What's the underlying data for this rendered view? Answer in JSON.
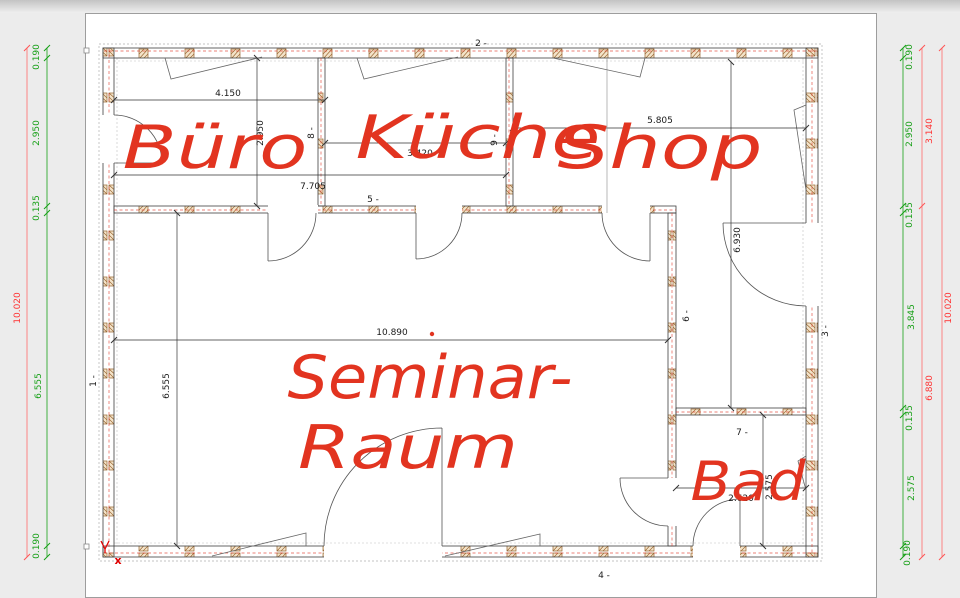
{
  "rooms": {
    "buero": "Büro",
    "kueche": "Küche",
    "shop": "Shop",
    "seminar_line1": "Seminar-",
    "seminar_line2": "Raum",
    "bad": "Bad"
  },
  "dims": {
    "buero_width": "4.150",
    "buero_height": "2.950",
    "buero_kueche_width": "7.705",
    "kueche_width": "3.420",
    "shop_width": "5.805",
    "shop_height": "6.930",
    "seminar_width": "10.890",
    "seminar_height": "6.555",
    "bad_width": "2.620",
    "bad_height": "2.575"
  },
  "wall_labels": {
    "w1": "1 -",
    "w2": "2 -",
    "w3": "3 -",
    "w4": "4 -",
    "w5": "5 -",
    "w6": "6 -",
    "w7": "7 -",
    "w8": "8 -",
    "w9": "9 -"
  },
  "left_margin": {
    "green": [
      "0.190",
      "2.950",
      "0.135",
      "6.555",
      "0.190"
    ],
    "red_total": "10.020"
  },
  "right_margin": {
    "green": [
      "0.190",
      "2.950",
      "0.135",
      "3.845",
      "0.135",
      "2.575",
      "0.190"
    ],
    "red": [
      "3.140",
      "6.880"
    ],
    "red_total": "10.020"
  },
  "origin": {
    "x_label": "x"
  },
  "colors": {
    "dim_green": "#17a017",
    "dim_red_line": "#ff6a6a",
    "dim_red_text": "#ff3333",
    "handwriting_red": "#e23420",
    "wall_hatch": "#96622c",
    "wall_outline": "#3f3f3f"
  }
}
